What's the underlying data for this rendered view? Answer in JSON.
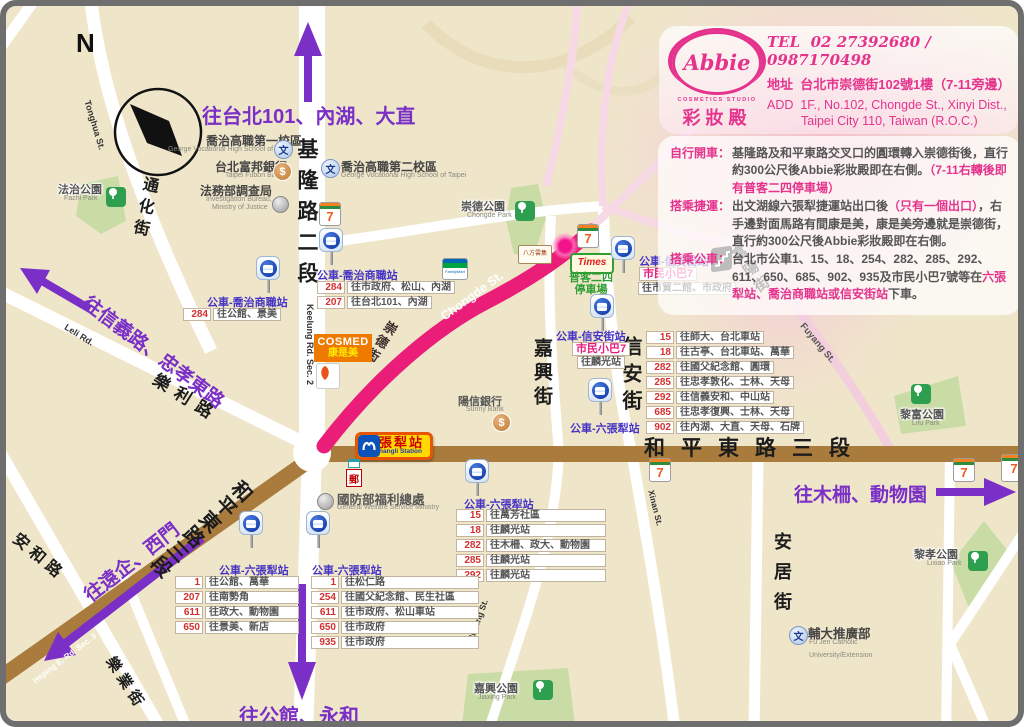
{
  "compass": {
    "n": "N"
  },
  "card": {
    "tel_label": "TEL",
    "tel": "02 27392680 / 0987170498",
    "addr_label": "地址",
    "addr": "台北市崇德街102號1樓（7-11旁邊）",
    "add_label": "ADD",
    "add1": "1F., No.102, Chongde St., Xinyi Dist.,",
    "add2": "Taipei City 110, Taiwan (R.O.C.)",
    "logo_name": "Abbie",
    "logo_sub": "COSMETICS STUDIO",
    "logo_zh": "彩妝殿"
  },
  "directions": {
    "drive": {
      "label": "自行開車：",
      "pre": "基隆路及和平東路交叉口的圓環轉入崇德街後，直行約300公尺後Abbie彩妝殿即在右側。",
      "hl": "（7-11右轉後即有普客二四停車場）",
      "post": ""
    },
    "mrt": {
      "label": "搭乘捷運：",
      "pre": "出文湖線六張犁捷運站出口後",
      "hl": "（只有一個出口）",
      "post": "，右手邊對面馬路有間康是美，康是美旁邊就是崇德街，直行約300公尺後Abbie彩妝殿即在右側。"
    },
    "bus": {
      "label": "搭乘公車：",
      "pre": "台北市公車1、15、18、254、282、285、292、611、650、685、902、935及市民小巴7號等在",
      "hl": "六張犁站、喬治商職站或信安街站",
      "post": "下車。"
    }
  },
  "arrows": {
    "north101": "往台北101、內湖、大直",
    "xinyi": "往信義路、忠孝東路",
    "yuanchi": "往遠企、西門",
    "muzha": "往木柵、動物園",
    "gongguan": "往公館、永和"
  },
  "roads": {
    "keelung2": "基隆路二段",
    "keelung2_en": "Keelung Rd. Sec. 2",
    "heping3": "和平東路三段",
    "heping3_en": "Heping E. Rd. Sec. 3",
    "chongde": "崇德街",
    "chongde_en": "Chongde St.",
    "tonghua": "通化街",
    "tonghua_en": "Tonghua St.",
    "leli": "樂利路",
    "leli_en": "Leli Rd.",
    "anhe": "安和路",
    "jiaxing": "嘉興街",
    "jiaxing_en": "Jiaxing St.",
    "xinan": "信安街",
    "xinan_en": "Xinan St.",
    "fuyang": "富陽街",
    "fuyang_en": "Fuyang St.",
    "anju": "安居街",
    "leye": "樂業街"
  },
  "parks": {
    "fazhi": {
      "zh": "法治公園",
      "en": "Fazhi Park"
    },
    "chongde": {
      "zh": "崇德公園",
      "en": "Chongde Park"
    },
    "lifu": {
      "zh": "黎富公園",
      "en": "Lifu Park"
    },
    "lixiao": {
      "zh": "黎孝公園",
      "en": "Lixiao Park"
    },
    "jiaxing": {
      "zh": "嘉興公園",
      "en": "Jiaxing Park"
    }
  },
  "landmarks": {
    "george1": {
      "zh": "喬治高職第一校區",
      "en": "George Vocational High School of Taipei"
    },
    "fubon": {
      "zh": "台北富邦銀行",
      "en": "Taipei Fubon Bank"
    },
    "bureau": {
      "zh": "法務部調查局",
      "en1": "Investigation Bureau,",
      "en2": "Ministry of Justice"
    },
    "george2": {
      "zh": "喬治高職第二校區",
      "en": "George Vocational High School of Taipei"
    },
    "sunny": {
      "zh": "陽信銀行",
      "en": "Sunny Bank"
    },
    "welfare": {
      "zh": "國防部福利總處",
      "en": "General Welfare Service Ministry"
    },
    "fujen": {
      "zh": "輔大推廣部",
      "en1": "Fu Jen Catholic",
      "en2": "University/Extension"
    },
    "cosmed": {
      "en": "COSMED",
      "zh": "康是美"
    },
    "times": {
      "brand": "Times",
      "p1": "普客二四",
      "p2": "停車場"
    },
    "bafang": "八方雲集"
  },
  "station": {
    "zh": "六張犁站",
    "en": "Liuzhangli Station"
  },
  "icons": {
    "seven": "7",
    "familymart": "FamilyMart",
    "dollar": "$",
    "school": "文",
    "post": "郵"
  },
  "bus": {
    "george_w": {
      "label": "公車-喬治商職站",
      "routes": [
        [
          "284",
          "往公館、景美"
        ]
      ]
    },
    "george_e": {
      "label": "公車-喬治商職站",
      "routes": [
        [
          "284",
          "往市政府、松山、內湖"
        ],
        [
          "207",
          "往台北101、內湖"
        ]
      ]
    },
    "xinan_n": {
      "label": "公車-信安街站",
      "minibus": "市民小巴7",
      "routes": [
        [
          "",
          "往市貿二館、市政府"
        ]
      ]
    },
    "xinan_s": {
      "label": "公車-信安街站",
      "minibus": "市民小巴7",
      "routes": [
        [
          "",
          "往麟光站"
        ]
      ]
    },
    "xinan_routes": {
      "routes": [
        [
          "15",
          "往師大、台北車站"
        ],
        [
          "18",
          "往古亭、台北車站、萬華"
        ],
        [
          "282",
          "往國父紀念館、圓環"
        ],
        [
          "285",
          "往忠孝敦化、士林、天母"
        ],
        [
          "292",
          "往信義安和、中山站"
        ],
        [
          "685",
          "往忠孝復興、士林、天母"
        ],
        [
          "902",
          "往內湖、大直、天母、石牌"
        ]
      ]
    },
    "liuzhangli_road": {
      "label": "公車-六張犁站"
    },
    "liuzhangli_c": {
      "label": "公車-六張犁站",
      "routes": [
        [
          "15",
          "往萬芳社區"
        ],
        [
          "18",
          "往麟光站"
        ],
        [
          "282",
          "往木柵、政大、動物園"
        ],
        [
          "285",
          "往麟光站"
        ],
        [
          "292",
          "往麟光站"
        ]
      ]
    },
    "liuzhangli_w": {
      "label": "公車-六張犁站",
      "routes": [
        [
          "1",
          "往公館、萬華"
        ],
        [
          "207",
          "往南勢角"
        ],
        [
          "611",
          "往政大、動物園"
        ],
        [
          "650",
          "往景美、新店"
        ]
      ]
    },
    "liuzhangli_e": {
      "label": "公車-六張犁站",
      "routes": [
        [
          "1",
          "往松仁路"
        ],
        [
          "254",
          "往國父紀念館、民生社區"
        ],
        [
          "611",
          "往市政府、松山車站"
        ],
        [
          "650",
          "往市政府"
        ],
        [
          "935",
          "往市政府"
        ]
      ]
    }
  },
  "colors": {
    "accent_pink": "#E5338D",
    "road_magenta": "#EA1E79",
    "purple": "#7A2FC6",
    "road_brown": "#A97C3E",
    "park_green": "#C9DCA6"
  }
}
